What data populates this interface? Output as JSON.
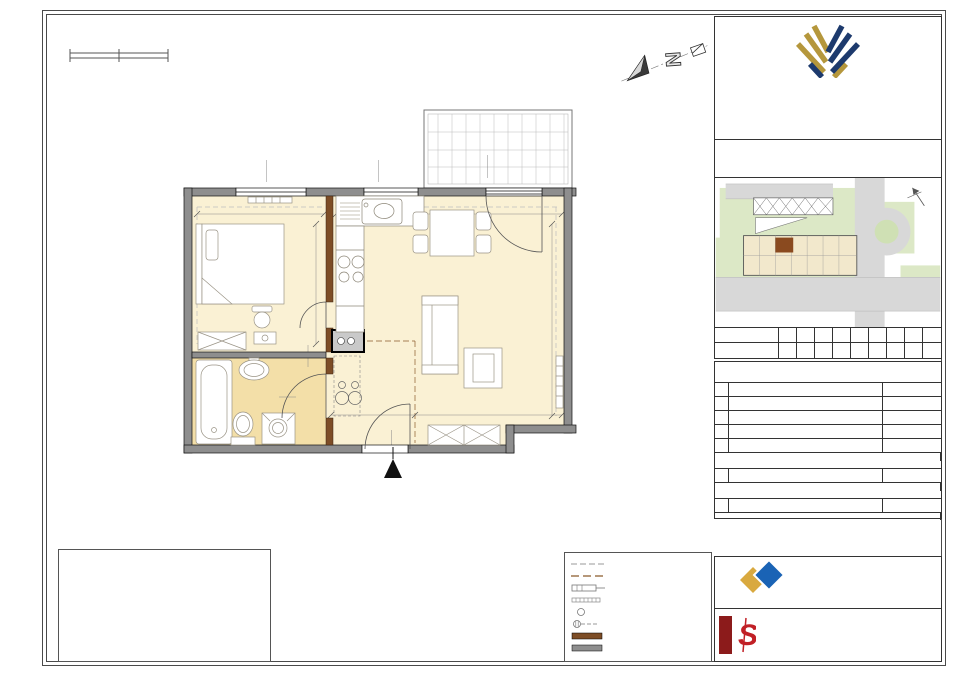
{
  "brand": {
    "title": "APARTAMENTY",
    "subtitle": "NAD POTOKIEM"
  },
  "building": {
    "line1": "BUDYNEK MIESZKALNO - USŁUGOWY",
    "line2": "przy ul. Modzelewskiego 24 w Warszawie"
  },
  "map": {
    "street": "Z. Modzelewskiego"
  },
  "scalebar": {
    "t0": "0",
    "t1": "100",
    "t2": "200cm"
  },
  "floors": {
    "label": "PIĘTRO",
    "row2_label": "MIESZKANIE NR",
    "cols": [
      "P",
      "I",
      "II",
      "III",
      "IV",
      "V",
      "VI",
      "VII",
      "VIII"
    ],
    "vals": [
      "-",
      "-",
      "-",
      "-",
      "-",
      "-",
      "39",
      "-",
      "-"
    ]
  },
  "areas": {
    "title": "ZESTAWIENIE POW. UŻYTKOWYCH POMIESZCZEŃ",
    "h_nr": "NR",
    "h_name": "NAZWA POMIESZCZENIA",
    "h_area": "POW. [m²]",
    "rows": [
      {
        "no": "1",
        "name": "PRZEDPOKÓJ",
        "area": "5,24 m²"
      },
      {
        "no": "2",
        "name": "POKÓJ Z ANEKSEM KUCHENNYM",
        "area": "23,22 m²"
      },
      {
        "no": "3",
        "name": "POKÓJ",
        "area": "10,25 m²"
      },
      {
        "no": "4",
        "name": "ŁAZIENKA",
        "area": "3,43 m²"
      }
    ],
    "sum1": {
      "name": "POW. UŻYTKOWA LOKALU",
      "area": "42,18 m²"
    },
    "row5": {
      "no": "5",
      "name": "POW. POD ŚCIANKAMI DZIAŁOWYMI",
      "area": "0,75 m²"
    },
    "sum2": {
      "name": "POW. WEWNĘTRZNA LOKALU",
      "area": "42,93 m²"
    },
    "row6": {
      "no": "6",
      "name": "BALKON",
      "area": "5,28 m²"
    },
    "height_row": {
      "name": "wysokość  mieszkania",
      "area": "2,68 m"
    }
  },
  "plan": {
    "entrance": "WEJŚCIE",
    "rooms": [
      {
        "n": "1",
        "x": 403,
        "y": 371
      },
      {
        "n": "2",
        "x": 450,
        "y": 268
      },
      {
        "n": "3",
        "x": 297,
        "y": 270
      },
      {
        "n": "4",
        "x": 257,
        "y": 404
      },
      {
        "n": "6",
        "x": 519,
        "y": 149
      }
    ],
    "texts": [
      {
        "t": "150",
        "x": 262,
        "y": 172,
        "r": -90
      },
      {
        "t": "153",
        "x": 271,
        "y": 172,
        "r": -90
      },
      {
        "t": "90",
        "x": 374,
        "y": 172,
        "r": -90
      },
      {
        "t": "133",
        "x": 383,
        "y": 172,
        "r": -90
      },
      {
        "t": "200",
        "x": 483,
        "y": 167,
        "r": -90
      },
      {
        "t": "234",
        "x": 492,
        "y": 167,
        "r": -90
      },
      {
        "t": "294.0",
        "x": 262,
        "y": 211
      },
      {
        "t": "516",
        "x": 452,
        "y": 211
      },
      {
        "t": "345",
        "x": 312,
        "y": 276,
        "r": -90
      },
      {
        "t": "365",
        "x": 342,
        "y": 255,
        "r": -90
      },
      {
        "t": "500.5",
        "x": 549,
        "y": 312,
        "r": -90
      },
      {
        "t": "80",
        "x": 287,
        "y": 393
      },
      {
        "t": "200",
        "x": 287,
        "y": 402
      },
      {
        "t": "80",
        "x": 304,
        "y": 356,
        "r": -90
      },
      {
        "t": "200",
        "x": 312,
        "y": 356,
        "r": -90
      },
      {
        "t": "188.5",
        "x": 318,
        "y": 402,
        "r": -90
      },
      {
        "t": "198.5",
        "x": 240,
        "y": 417
      },
      {
        "t": "281.5",
        "x": 352,
        "y": 412
      },
      {
        "t": "334.5",
        "x": 492,
        "y": 412
      },
      {
        "t": "90",
        "x": 387,
        "y": 441,
        "r": -90
      },
      {
        "t": "205",
        "x": 396,
        "y": 441,
        "r": -90
      },
      {
        "t": "obniżenie 25cm",
        "x": 224,
        "y": 204,
        "s": 4.3,
        "c": "#9a9a9a"
      },
      {
        "t": "obniżenie 25cm",
        "x": 450,
        "y": 204,
        "s": 4.3,
        "c": "#9a9a9a"
      },
      {
        "t": "obniżenie 25cm",
        "x": 201,
        "y": 293,
        "r": -90,
        "s": 4.3,
        "c": "#9a9a9a"
      },
      {
        "t": "obniżenie 25cm",
        "x": 350,
        "y": 232,
        "r": -90,
        "s": 4.3,
        "c": "#9a9a9a"
      },
      {
        "t": "obniżenie 40cm",
        "x": 360,
        "y": 388,
        "r": -90,
        "s": 4.3,
        "c": "#9a9a9a"
      }
    ]
  },
  "disclaimer": {
    "text": "NINIEJSZA KARTA KATALOGOWA ZOSTAŁA OPRACOWANA NA PODSTAWIE PROJEKTU BUDOWLANEGO\nNIE STANOWI ONA WIERNEGO ODWZOROWANIA POWSTAŁEGO LOKALU MIESZKALNEGO\nKARTY MAJĄ JEDYNIE SŁUŻYĆ WSKAZANIU POŁOŻENIA PROJEKTOWANYCH POMIESZCZEŃ\nLOKALU WRYSOWANYCH NA PODSTAWIE PROJEKTU BUDOWLANEGO. W TOKU DALSZEGO\nPROJEKTOWANIA MOGĄ WYSTĄPIĆ NIEWIELKIE ZMIANY W STOSUNKU DO INFORMACJI\nZAWARTYCH W KARCIE KATALOGOWEJ. NINIEJSZA KARTA NIE STANOWI WIĄŻĄCEGO OPISU\nPREZENTOWANEGO LOKALU. PROJEKT CHRONIONY PRAWEM AUTORSKIM.\nRYSUNEK NIE PRZEZNACZONY DO CELÓW WYKONAWCZYCH."
  },
  "notes": {
    "title": "UWAGA:",
    "items": [
      {
        "no": "1.",
        "text": "PODANE WYMIARY SĄ WYMIARAMI W ŚWIETLE PIONOWYCH PRZEGRÓD (ŚCIAN)\nW STANIE SUROWYM (BEZ TYNKU). LOKALIZACJE PRZYBORÓW SANITARNYCH,\nOSPRZĘTU ELEKTRYCZNEGO ITP. PODANO ORIENTACYJNIE\nNA BAZIE PROJEKTU BUDOWLANEGO. W TRAKCIE REALIZACJI PRAC BUDOWLANYCH\nMOGĄ WYSTĄPIĆ NIEWIELKIE RÓŻNICE WYMIARÓW I USYTUOWANIA ELEMENTÓW.\nWYSOKOŚCI LICZONE OD POZIOMU DOCELOWO WYKOŃCZONEJ PODŁOGI."
      },
      {
        "no": "2.",
        "text": "POWIERZCHNIA UŻYTKOWA LOKALU JEST OKREŚLONA NA PODSTAWIE\nROZPORZĄDZENIA MINISTRA TRANSPORTU, BUDOWNICTWA I GOSPODARKI MORSKIEJ\nZ DN. 25.04.2012R. W SPRAWIE SZCZEGÓŁOWEGO ZAKRESU I FORMY PROJEKTU\nBUDOWLANEGO (DZ. U. Z 2012R., poz. 462). ZGODNIE Z ZASADAMI ZAWARTYMI\nW POLSKIEJ NORMIE PN-ISO 9836: 1997.\nPOWIERZCHNIA SPRZEDAŻOWA (WEWNĘTRZNA LOKALU) STANOWI SUMĘ POWIERZCHNI\nUŻYTKOWEJ LOKALU ORAZ POWIERZCHNI POD ŚCIANKAMI DZIAŁOWYMI\nZ MOŻLIWOŚCIĄ ZMIANY ARANŻACJI."
      },
      {
        "no": "3.",
        "text": "PRZEDSTAWIONA NA RZUTACH ARANŻACJA MA CHARAKTER PRZYKŁADOWY.\nUMEBLOWANIE NIE STANOWI WYPOSAŻENIA NABYWANEGO LOKALU."
      }
    ]
  },
  "legend": {
    "items": [
      {
        "label": "obniżenia"
      },
      {
        "label": "obrys powierzchni"
      },
      {
        "label": "grzejnik płytowy"
      },
      {
        "label": "grzejnik drabinkowy"
      },
      {
        "label": "pion kanalizacyjny"
      },
      {
        "label": "wentylacja wyciągowa"
      },
      {
        "label": "ściana działowa z możliwością zmiany aranżacji"
      },
      {
        "label": "ściana nierozbieralna"
      }
    ]
  },
  "kalter": {
    "name": "KALTER",
    "sub": "NIERUCHOMOŚCI",
    "contact": "Kalter Nieruchomości Projekt 10 Sp. z o.o.\nul. Augustowska 8 15-218 Białystok\nwww.kalternieruchomosci.pl\n\nBiuro sprzedaży Warszawa\nul. Pańska 98 lokal 102,\n00-834 Warszawa,\nT. 22 509 72 72, M. 731 808 316,\nE. warszawa@kalternieruchomosci.pl"
  },
  "architect": {
    "name": "PASTEWKA I STRÓJ",
    "sub": "ARCHITEKCI",
    "address": "Al. Jerozolimskie 99 lok.37\n02-001 Warszawa\nwww.ps-architekci.pl\nbiuro@ps-architekci.pl"
  },
  "colors": {
    "navy": "#1d3a6d",
    "gold": "#b5973c",
    "wall_gray": "#8e8e8e",
    "partition_brown": "#7d4d26",
    "floor_cream": "#faf1d4",
    "bath_tone": "#f3dfa8",
    "kalter_blue": "#1a63b5",
    "kalter_gold": "#d9a93f",
    "ps_red": "#c12026"
  }
}
